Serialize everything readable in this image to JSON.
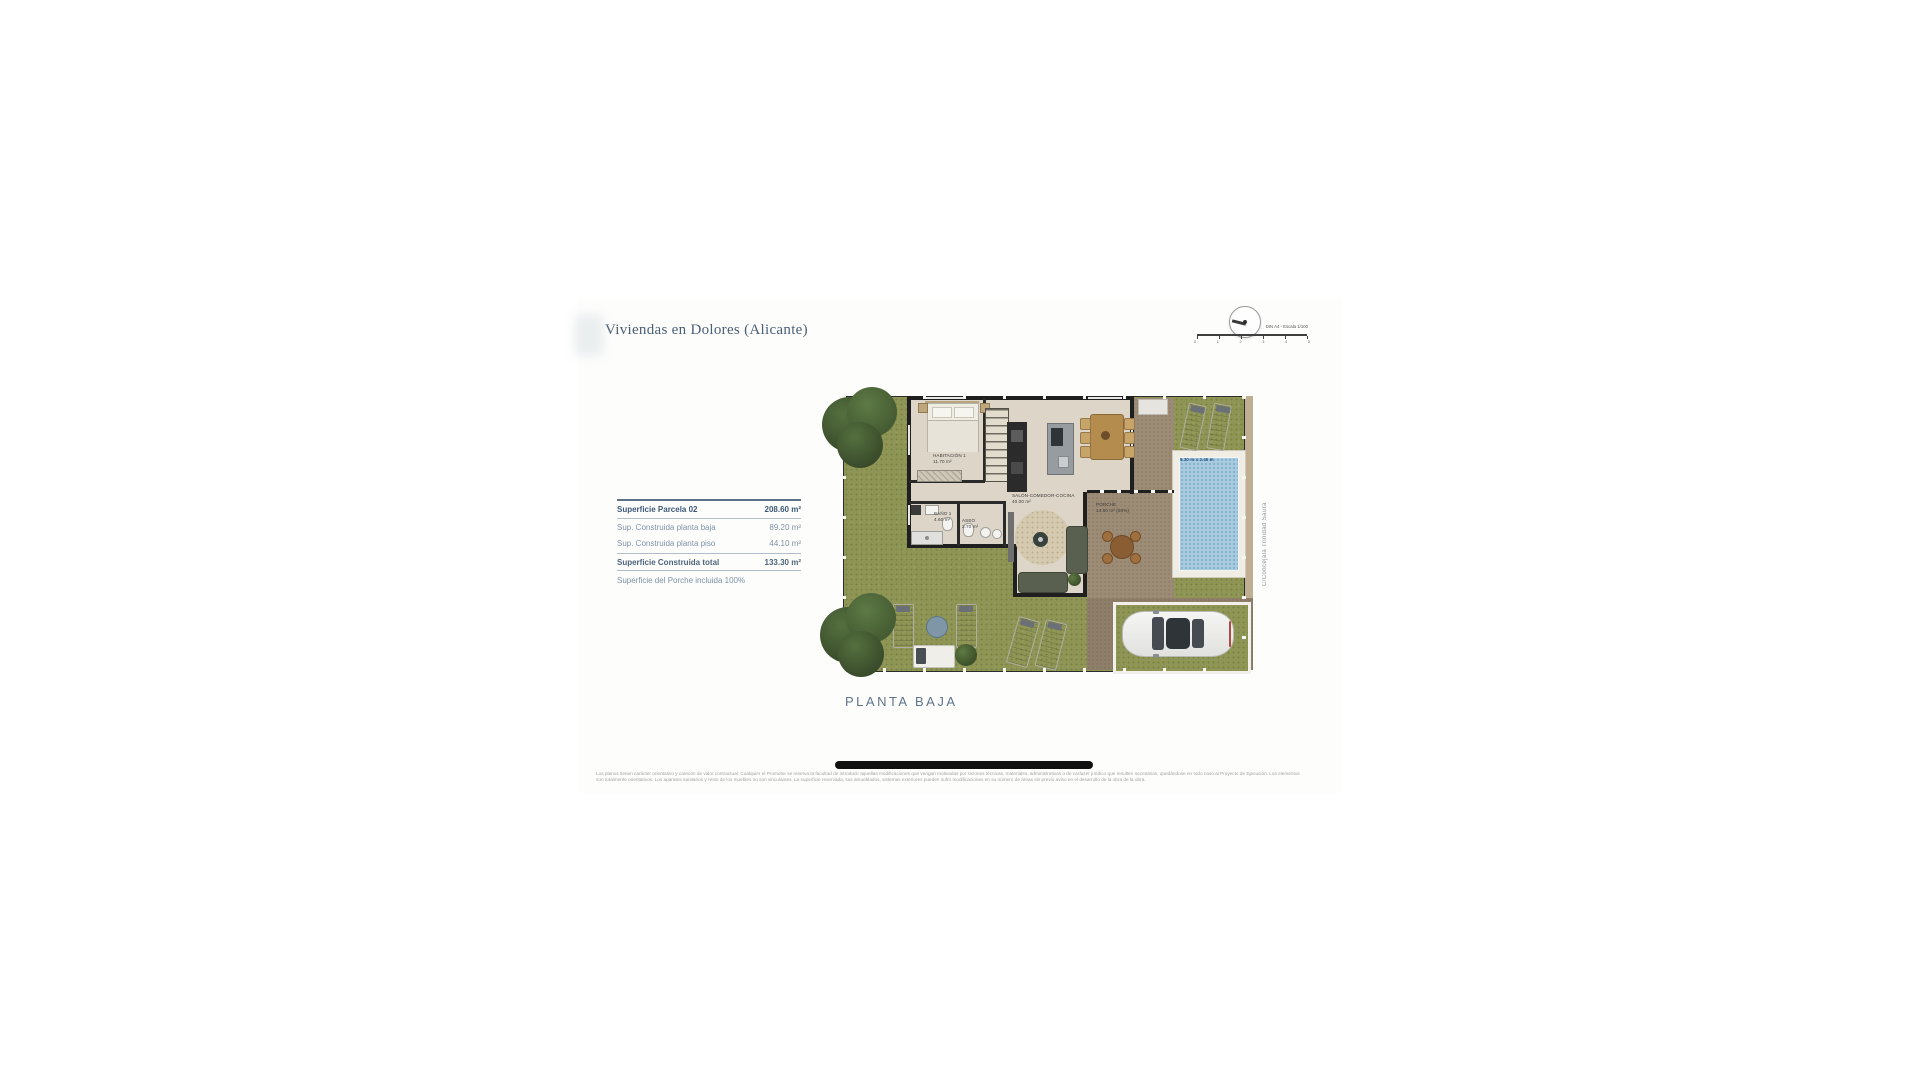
{
  "header": {
    "title": "Viviendas en Dolores (Alicante)"
  },
  "compass": {
    "scale_text": "DIN A4 - Escala 1/100",
    "ticks": [
      "0",
      "1",
      "2",
      "3",
      "4",
      "5"
    ]
  },
  "surface_table": {
    "header_row": {
      "label": "Superficie Parcela 02",
      "value": "208.60 m²"
    },
    "rows": [
      {
        "label": "Sup. Construida planta baja",
        "value": "89.20 m²"
      },
      {
        "label": "Sup. Construida planta piso",
        "value": "44.10 m²"
      }
    ],
    "total_row": {
      "label": "Superficie Construida total",
      "value": "133.30 m²"
    },
    "note": "Superficie del Porche incluida 100%"
  },
  "plan": {
    "caption": "PLANTA BAJA",
    "street": "C/Concejala Trinidad Saura",
    "rooms": {
      "habitacion": {
        "name": "HABITACIÓN 1",
        "area": "11.70 m²"
      },
      "salon": {
        "name": "SALÓN-COMEDOR-COCINA",
        "area": "40.00 m²"
      },
      "bano": {
        "name": "BAÑO 1",
        "area": "4.60 m²"
      },
      "aseo": {
        "name": "ASEO",
        "area": "2.70 m²"
      },
      "porche": {
        "name": "PORCHE",
        "area": "14.50 m² (50%)"
      }
    },
    "pool": {
      "dimensions": "5.30 m x 2.46 m"
    }
  },
  "footer": {
    "disclaimer_line1": "Los planos tienen carácter orientativo y carecen de valor contractual. Cualquier el Promotor se reserva la facultad de introducir aquellas modificaciones que vengan motivadas por razones técnicas, materiales, administrativas o de carácter jurídico que resulten necesarias, quedándose en todo caso al Proyecto de Ejecución. Los elementos",
    "disclaimer_line2": "son totalmente orientativos. Los aparatos sanitarios y resto de los muebles no son vinculantes. La superficie reservada, sus amueblados, sistemas exteriores pueden sufrir modificaciones en su número de áreas sin previo aviso en el desarrollo de la obra de la obra."
  },
  "colors": {
    "grass": "#8f9655",
    "pool": "#a9cadf",
    "paving": "#9c8b75",
    "wall": "#1f1f1f",
    "title_text": "#4a5f74",
    "table_text": "#7d92a6",
    "table_accent": "#3d5878",
    "caption_text": "#60748c"
  }
}
